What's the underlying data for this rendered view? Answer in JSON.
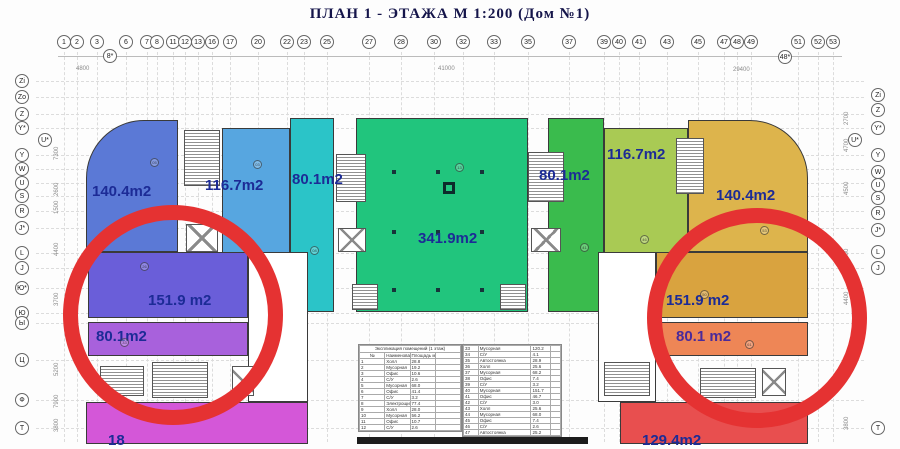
{
  "title": "ПЛАН   1 - ЭТАЖА  М 1:200  (Дом №1)",
  "axes": {
    "top": [
      {
        "label": "1",
        "x": 64
      },
      {
        "label": "2",
        "x": 77
      },
      {
        "label": "3",
        "x": 97
      },
      {
        "label": "6",
        "x": 126
      },
      {
        "label": "7",
        "x": 147
      },
      {
        "label": "8",
        "x": 157
      },
      {
        "label": "11",
        "x": 173
      },
      {
        "label": "12",
        "x": 185
      },
      {
        "label": "13",
        "x": 198
      },
      {
        "label": "16",
        "x": 212
      },
      {
        "label": "17",
        "x": 230
      },
      {
        "label": "20",
        "x": 258
      },
      {
        "label": "22",
        "x": 287
      },
      {
        "label": "23",
        "x": 304
      },
      {
        "label": "25",
        "x": 327
      },
      {
        "label": "27",
        "x": 369
      },
      {
        "label": "28",
        "x": 401
      },
      {
        "label": "30",
        "x": 434
      },
      {
        "label": "32",
        "x": 463
      },
      {
        "label": "33",
        "x": 494
      },
      {
        "label": "35",
        "x": 528
      },
      {
        "label": "37",
        "x": 569
      },
      {
        "label": "39",
        "x": 604
      },
      {
        "label": "40",
        "x": 619
      },
      {
        "label": "41",
        "x": 639
      },
      {
        "label": "43",
        "x": 667
      },
      {
        "label": "45",
        "x": 698
      },
      {
        "label": "47",
        "x": 724
      },
      {
        "label": "48",
        "x": 737
      },
      {
        "label": "49",
        "x": 751
      },
      {
        "label": "51",
        "x": 798
      },
      {
        "label": "52",
        "x": 818
      },
      {
        "label": "53",
        "x": 833
      }
    ],
    "top_offset": [
      {
        "label": "8*",
        "x": 110,
        "y": 56
      },
      {
        "label": "48*",
        "x": 785,
        "y": 57
      }
    ],
    "left": [
      {
        "label": "Zi",
        "y": 81
      },
      {
        "label": "Zo",
        "y": 97
      },
      {
        "label": "Z",
        "y": 114
      },
      {
        "label": "Y*",
        "y": 128
      },
      {
        "label": "Y",
        "y": 155
      },
      {
        "label": "W",
        "y": 169
      },
      {
        "label": "U",
        "y": 183
      },
      {
        "label": "S",
        "y": 196
      },
      {
        "label": "R",
        "y": 211
      },
      {
        "label": "J*",
        "y": 228
      },
      {
        "label": "L",
        "y": 253
      },
      {
        "label": "J",
        "y": 268
      },
      {
        "label": "Ю*",
        "y": 288
      },
      {
        "label": "Ю",
        "y": 313
      },
      {
        "label": "Ы",
        "y": 323
      },
      {
        "label": "Ц",
        "y": 360
      },
      {
        "label": "Ф",
        "y": 400
      },
      {
        "label": "Т",
        "y": 428
      }
    ],
    "left_inset": {
      "label": "U*",
      "x": 45,
      "y": 140
    },
    "right": [
      {
        "label": "Zi",
        "y": 95
      },
      {
        "label": "Z",
        "y": 110
      },
      {
        "label": "Y*",
        "y": 128
      },
      {
        "label": "Y",
        "y": 155
      },
      {
        "label": "W",
        "y": 172
      },
      {
        "label": "U",
        "y": 185
      },
      {
        "label": "S",
        "y": 198
      },
      {
        "label": "R",
        "y": 213
      },
      {
        "label": "J*",
        "y": 230
      },
      {
        "label": "L",
        "y": 252
      },
      {
        "label": "J",
        "y": 268
      },
      {
        "label": "Т",
        "y": 428
      }
    ],
    "right_inset": {
      "label": "U*",
      "x": 855,
      "y": 140
    }
  },
  "units": [
    {
      "name": "unit-140-left",
      "label": "140.4m2",
      "color": "#5b79d6",
      "x": 86,
      "y": 120,
      "w": 92,
      "h": 132,
      "rtl": 58,
      "lx": 92,
      "ly": 183,
      "lc": "#1c2b96"
    },
    {
      "name": "unit-116-left",
      "label": "116.7m2",
      "color": "#57a6e0",
      "x": 222,
      "y": 128,
      "w": 68,
      "h": 184,
      "lx": 205,
      "ly": 177,
      "lc": "#1c2b96"
    },
    {
      "name": "unit-80-cyan",
      "label": "80.1m2",
      "color": "#2bc4c8",
      "x": 290,
      "y": 118,
      "w": 44,
      "h": 194,
      "lx": 292,
      "ly": 171,
      "lc": "#1c2b96"
    },
    {
      "name": "unit-341-center",
      "label": "341.9m2",
      "color": "#21c57d",
      "x": 356,
      "y": 118,
      "w": 172,
      "h": 194,
      "lx": 418,
      "ly": 230,
      "lc": "#1c2b96"
    },
    {
      "name": "unit-80-green",
      "label": "80.1m2",
      "color": "#3abb4d",
      "x": 548,
      "y": 118,
      "w": 56,
      "h": 194,
      "lx": 539,
      "ly": 167,
      "lc": "#1c2b96"
    },
    {
      "name": "unit-116-right",
      "label": "116.7m2",
      "color": "#a9ca54",
      "x": 604,
      "y": 128,
      "w": 84,
      "h": 184,
      "lx": 607,
      "ly": 146,
      "lc": "#1c2b96"
    },
    {
      "name": "unit-140-right",
      "label": "140.4m2",
      "color": "#ddb44c",
      "x": 688,
      "y": 120,
      "w": 120,
      "h": 132,
      "rtr": 58,
      "lx": 716,
      "ly": 187,
      "lc": "#1c2b96"
    },
    {
      "name": "rooms-left-wing",
      "label": "",
      "color": "#ffffff",
      "x": 248,
      "y": 252,
      "w": 60,
      "h": 150
    },
    {
      "name": "unit-151-left",
      "label": "151.9 m2",
      "color": "#6a5ed9",
      "x": 88,
      "y": 252,
      "w": 160,
      "h": 66,
      "lx": 148,
      "ly": 292,
      "lc": "#1c2b96"
    },
    {
      "name": "unit-80-purple",
      "label": "80.1m2",
      "color": "#a861dc",
      "x": 88,
      "y": 322,
      "w": 160,
      "h": 34,
      "lx": 96,
      "ly": 328,
      "lc": "#1c2b96"
    },
    {
      "name": "unit-magenta-left",
      "label": "18",
      "color": "#d457d8",
      "x": 86,
      "y": 402,
      "w": 222,
      "h": 42,
      "lx": 108,
      "ly": 432,
      "lc": "#1c2b96"
    },
    {
      "name": "rooms-right-wing",
      "label": "",
      "color": "#ffffff",
      "x": 598,
      "y": 252,
      "w": 58,
      "h": 150
    },
    {
      "name": "unit-151-right",
      "label": "151.9 m2",
      "color": "#d9a33f",
      "x": 656,
      "y": 252,
      "w": 152,
      "h": 66,
      "lx": 666,
      "ly": 292,
      "lc": "#1c2b96"
    },
    {
      "name": "unit-80-salmon",
      "label": "80.1 m2",
      "color": "#ee8656",
      "x": 656,
      "y": 322,
      "w": 152,
      "h": 34,
      "lx": 676,
      "ly": 328,
      "lc": "#4a2a9a"
    },
    {
      "name": "unit-red-right",
      "label": "129.4m2",
      "color": "#e84f4f",
      "x": 620,
      "y": 402,
      "w": 188,
      "h": 42,
      "lx": 642,
      "ly": 432,
      "lc": "#1c2b96"
    }
  ],
  "stairs": [
    {
      "x": 184,
      "y": 130,
      "w": 36,
      "h": 56
    },
    {
      "x": 336,
      "y": 154,
      "w": 30,
      "h": 48
    },
    {
      "x": 528,
      "y": 152,
      "w": 36,
      "h": 50
    },
    {
      "x": 676,
      "y": 138,
      "w": 28,
      "h": 56
    },
    {
      "x": 100,
      "y": 366,
      "w": 44,
      "h": 30
    },
    {
      "x": 152,
      "y": 362,
      "w": 56,
      "h": 36
    },
    {
      "x": 604,
      "y": 362,
      "w": 46,
      "h": 34
    },
    {
      "x": 700,
      "y": 368,
      "w": 56,
      "h": 30
    },
    {
      "x": 352,
      "y": 284,
      "w": 26,
      "h": 26
    },
    {
      "x": 500,
      "y": 284,
      "w": 26,
      "h": 26
    }
  ],
  "elevators": [
    {
      "x": 186,
      "y": 224,
      "w": 32,
      "h": 28
    },
    {
      "x": 338,
      "y": 228,
      "w": 28,
      "h": 24
    },
    {
      "x": 531,
      "y": 228,
      "w": 30,
      "h": 24
    },
    {
      "x": 232,
      "y": 366,
      "w": 22,
      "h": 30
    },
    {
      "x": 762,
      "y": 368,
      "w": 24,
      "h": 28
    }
  ],
  "columns": {
    "xs": [
      392,
      436,
      480
    ],
    "ys": [
      170,
      230,
      288
    ]
  },
  "mark_square": {
    "x": 443,
    "y": 182
  },
  "room_numbers": [
    {
      "n": "05",
      "x": 150,
      "y": 158
    },
    {
      "n": "03",
      "x": 253,
      "y": 160
    },
    {
      "n": "08",
      "x": 310,
      "y": 246
    },
    {
      "n": "13",
      "x": 455,
      "y": 163
    },
    {
      "n": "41",
      "x": 580,
      "y": 243
    },
    {
      "n": "46",
      "x": 640,
      "y": 235
    },
    {
      "n": "53",
      "x": 760,
      "y": 226
    },
    {
      "n": "26",
      "x": 140,
      "y": 262
    },
    {
      "n": "33",
      "x": 120,
      "y": 338
    },
    {
      "n": "50",
      "x": 700,
      "y": 290
    },
    {
      "n": "61",
      "x": 745,
      "y": 340
    }
  ],
  "dims_top": [
    {
      "t": "4800",
      "x": 76,
      "y": 66
    },
    {
      "t": "41000",
      "x": 438,
      "y": 66
    },
    {
      "t": "29400",
      "x": 733,
      "y": 67
    }
  ],
  "dims_left": [
    {
      "t": "7300",
      "y": 160
    },
    {
      "t": "2600",
      "y": 196
    },
    {
      "t": "1500",
      "y": 214
    },
    {
      "t": "4400",
      "y": 256
    },
    {
      "t": "3700",
      "y": 306
    },
    {
      "t": "5200",
      "y": 376
    },
    {
      "t": "7900",
      "y": 408
    },
    {
      "t": "3800",
      "y": 432
    }
  ],
  "dims_right": [
    {
      "t": "2700",
      "y": 125
    },
    {
      "t": "4700",
      "y": 152
    },
    {
      "t": "4500",
      "y": 195
    },
    {
      "t": "1500",
      "y": 262
    },
    {
      "t": "4400",
      "y": 305
    },
    {
      "t": "3800",
      "y": 430
    }
  ],
  "tables": [
    {
      "x": 358,
      "y": 344,
      "w": 102,
      "caption": "Экспликация помещений (1 этаж)",
      "headers": [
        "№",
        "Наименование",
        "Площадь м²",
        ""
      ],
      "rows": [
        [
          "1",
          "Холл",
          "28.8"
        ],
        [
          "2",
          "Мусорная",
          "19.2"
        ],
        [
          "3",
          "Офис",
          "10.6"
        ],
        [
          "4",
          "С/У",
          "2.6"
        ],
        [
          "5",
          "Мусорная",
          "68.0"
        ],
        [
          "6",
          "Офис",
          "41.4"
        ],
        [
          "7",
          "С/У",
          "3.2"
        ],
        [
          "8",
          "Электрощитовая",
          "77.4"
        ],
        [
          "9",
          "Холл",
          "28.0"
        ],
        [
          "10",
          "Мусорная",
          "56.2"
        ],
        [
          "11",
          "Офис",
          "10.7"
        ],
        [
          "12",
          "С/У",
          "2.6"
        ]
      ]
    },
    {
      "x": 462,
      "y": 344,
      "w": 98,
      "caption": "",
      "headers": [],
      "rows": [
        [
          "33",
          "Мусорная",
          "120.2"
        ],
        [
          "34",
          "С/У",
          "4.1"
        ],
        [
          "35",
          "Автостоянка",
          "28.9"
        ],
        [
          "36",
          "Холл",
          "25.6"
        ],
        [
          "37",
          "Мусорная",
          "68.2"
        ],
        [
          "38",
          "Офис",
          "7.4"
        ],
        [
          "39",
          "С/У",
          "3.2"
        ],
        [
          "40",
          "Мусорная",
          "151.7"
        ],
        [
          "41",
          "Офис",
          "46.7"
        ],
        [
          "42",
          "С/У",
          "3.0"
        ],
        [
          "43",
          "Холл",
          "25.6"
        ],
        [
          "44",
          "Мусорная",
          "68.0"
        ],
        [
          "45",
          "Офис",
          "7.4"
        ],
        [
          "46",
          "С/У",
          "2.6"
        ],
        [
          "47",
          "Автостоянка",
          "25.2"
        ]
      ]
    }
  ],
  "red_circles": [
    {
      "x": 63,
      "y": 205,
      "d": 220
    },
    {
      "x": 647,
      "y": 208,
      "d": 220
    }
  ],
  "black_bar": {
    "x": 357,
    "y": 437,
    "w": 231,
    "h": 7
  },
  "colors": {
    "annotation_red": "#e53232",
    "label_navy": "#1c2b96",
    "title": "#15154a",
    "grid": "#dcdcdc"
  }
}
